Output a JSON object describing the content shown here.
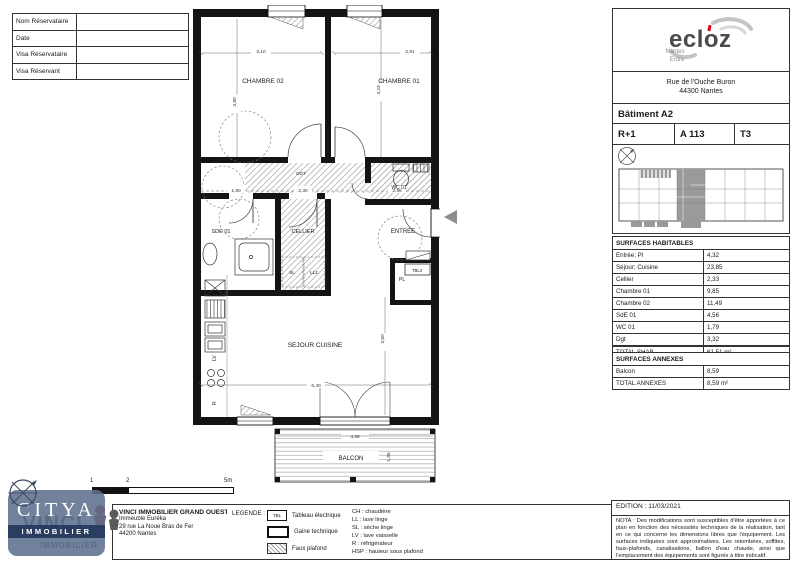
{
  "reservation": {
    "rows": [
      "Nom Réservataire",
      "Date",
      "Visa Réservataire",
      "Visa Réservant"
    ]
  },
  "plan": {
    "labels": {
      "chambre02": "CHAMBRE 02",
      "chambre01": "CHAMBRE 01",
      "wc": "WC 01",
      "sde": "SDE 01",
      "cellier": "CELLIER",
      "dgt": "DGT",
      "entree": "ENTREE",
      "sejour": "SEJOUR CUISINE",
      "balcon": "BALCON",
      "pl": "PL",
      "tbl": "TBL3",
      "sl": "SL",
      "ll": "LL1",
      "lv": "LV",
      "r": "R"
    },
    "dims": {
      "chambre02_w": "3,10",
      "chambre01_w": "2,91",
      "chambre02_h": "3,80",
      "chambre01_h": "3,23",
      "sde_w": "1,90",
      "dgt_w": "2,30",
      "entree_w": "2,96",
      "sejour_w": "6,40",
      "sejour_h": "3,60",
      "balcon_w": "4,39",
      "balcon_d": "1,95"
    }
  },
  "panel": {
    "brand": {
      "name": "ecloz",
      "region_line1": "Nantes",
      "region_line2": "Erdre"
    },
    "address_line1": "Rue de l'Ouche Buron",
    "address_line2": "44300 Nantes",
    "batiment": "Bâtiment A2",
    "etage": "R+1",
    "lot": "A 113",
    "type": "T3",
    "surfaces_habitables": {
      "title": "SURFACES HABITABLES",
      "rows": [
        {
          "label": "Entrée; Pl",
          "value": "4,32"
        },
        {
          "label": "Séjour; Cuisine",
          "value": "23,85"
        },
        {
          "label": "Cellier",
          "value": "2,33"
        },
        {
          "label": "Chambre 01",
          "value": "9,85"
        },
        {
          "label": "Chambre 02",
          "value": "11,49"
        },
        {
          "label": "SdE 01",
          "value": "4,56"
        },
        {
          "label": "WC 01",
          "value": "1,79"
        },
        {
          "label": "Dgt",
          "value": "3,32"
        }
      ],
      "total_label": "TOTAL SHAB",
      "total_value": "61,51 m²"
    },
    "surfaces_annexes": {
      "title": "SURFACES ANNEXES",
      "rows": [
        {
          "label": "Balcon",
          "value": "8,59"
        }
      ],
      "total_label": "TOTAL ANNEXES",
      "total_value": "8,59 m²"
    }
  },
  "footer": {
    "vinci": {
      "title": "VINCI IMMOBILIER GRAND OUEST",
      "line1": "Immeuble Euréka",
      "line2": "29 rue La Noue Bras de Fer",
      "line3": "44200 Nantes"
    },
    "legende": {
      "title": "LEGENDE :",
      "items": [
        {
          "label": "Tableau électrique"
        },
        {
          "label": "Gaine technique"
        },
        {
          "label": "Faux plafond"
        }
      ]
    },
    "abbreviations": [
      "CH : chaudière",
      "LL : lave linge",
      "SL : sèche linge",
      "LV : lave vaisselle",
      "R : réfrigérateur",
      "HSP : hauteur sous plafond"
    ],
    "edition": "EDITION : 11/03/2021",
    "nota": "NOTA : Des modifications sont susceptibles d'être apportées à ce plan en fonction des nécessités techniques de la réalisation, tant en ce qui concerne les dimensions libres que l'équipement. Les surfaces indiquées sont approximatives. Les retombées, soffites, faux-plafonds, canalisations, ballon d'eau chaude, ainsi que l'emplacement des équipements sont figurés à titre indicatif."
  },
  "scalebar": {
    "labels": [
      "1",
      "2",
      "5m"
    ]
  },
  "logos": {
    "citya_name": "CITYA",
    "citya_sub": "IMMOBILIER",
    "vinci_name": "VINCI",
    "vinci_sub": "IMMOBILIER"
  }
}
